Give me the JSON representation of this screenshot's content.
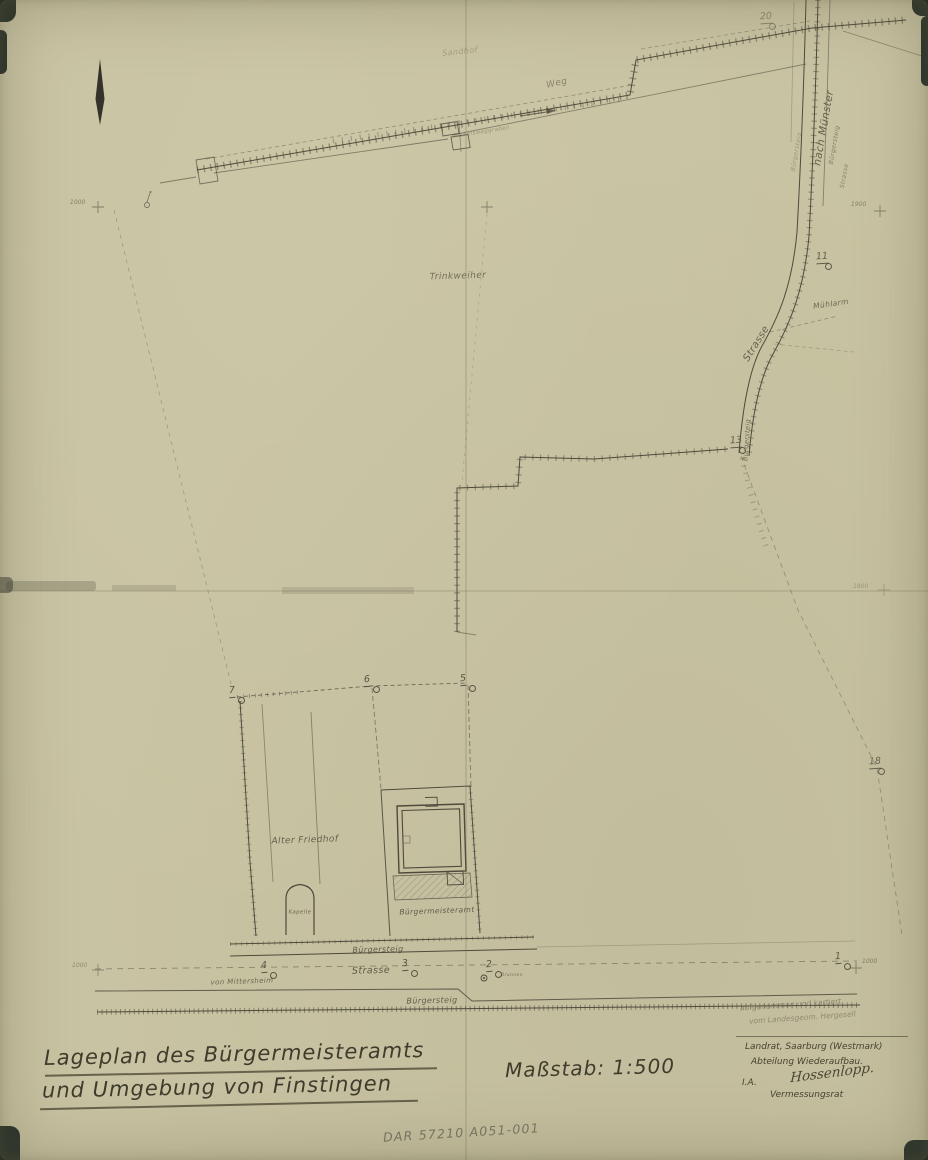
{
  "colors": {
    "paper": "#c8c3a2",
    "ink": "#4e4a3c",
    "faint_ink": "#80785f",
    "pencil": "#6d6959",
    "backdrop": "#28332c"
  },
  "annotations": {
    "title_line1": "Lageplan des Bürgermeisteramts",
    "title_line2": "und Umgebung von Finstingen",
    "scale": "Maßstab: 1:500",
    "credit_line1": "aufgenommen und kartiert",
    "credit_line2": "vom Landesgeom. Hergesell",
    "office_line1": "Landrat, Saarburg (Westmark)",
    "office_line2": "Abteilung Wiederaufbau.",
    "office_ia": "I.A.",
    "office_signature": "Hossenlopp.",
    "office_role": "Vermessungsrat",
    "archive_ref": "DAR 57210 A051-001"
  },
  "map": {
    "labels": [
      {
        "id": "sandhof",
        "text": "Sandhof",
        "x": 460,
        "y": 52,
        "rot": -6,
        "size": 8,
        "op": 0.32
      },
      {
        "id": "weg",
        "text": "Weg",
        "x": 557,
        "y": 84,
        "rot": -12,
        "size": 9,
        "op": 0.55
      },
      {
        "id": "weggraben",
        "text": "Rickelsweggraben",
        "x": 482,
        "y": 133,
        "rot": -9,
        "size": 5.5,
        "op": 0.42
      },
      {
        "id": "trinkweiher",
        "text": "Trinkweiher",
        "x": 458,
        "y": 277,
        "rot": -2,
        "size": 9,
        "op": 0.75
      },
      {
        "id": "nach-muenster",
        "text": "nach Münster",
        "x": 824,
        "y": 128,
        "rot": -80,
        "size": 10.5,
        "op": 0.85
      },
      {
        "id": "buergersteig-muenster",
        "text": "Bürgersteig",
        "x": 835,
        "y": 145,
        "rot": -80,
        "size": 6,
        "op": 0.6
      },
      {
        "id": "strasse-muenster",
        "text": "Strasse",
        "x": 845,
        "y": 176,
        "rot": -80,
        "size": 6,
        "op": 0.55
      },
      {
        "id": "buergersteig-saar",
        "text": "Bürgersteig",
        "x": 797,
        "y": 152,
        "rot": -80,
        "size": 6,
        "op": 0.38
      },
      {
        "id": "muehlarm",
        "text": "Mühlarm",
        "x": 831,
        "y": 304,
        "rot": -8,
        "size": 7.5,
        "op": 0.8
      },
      {
        "id": "strasse-diagonal",
        "text": "Strasse",
        "x": 757,
        "y": 344,
        "rot": -58,
        "size": 10,
        "op": 0.85
      },
      {
        "id": "buergersteig-kurve",
        "text": "Bürgersteig",
        "x": 747,
        "y": 440,
        "rot": -86,
        "size": 6.5,
        "op": 0.75
      },
      {
        "id": "alter-friedhof",
        "text": "Alter Friedhof",
        "x": 305,
        "y": 841,
        "rot": -2,
        "size": 9,
        "op": 0.85
      },
      {
        "id": "kapelle",
        "text": "Kapelle",
        "x": 300,
        "y": 913,
        "rot": 0,
        "size": 5.5,
        "op": 0.8
      },
      {
        "id": "buergermeisteramt",
        "text": "Bürgermeisteramt",
        "x": 437,
        "y": 911,
        "rot": -2,
        "size": 7.5,
        "op": 0.9
      },
      {
        "id": "buergersteig-oben",
        "text": "Bürgersteig",
        "x": 378,
        "y": 950,
        "rot": -1.5,
        "size": 8,
        "op": 0.9
      },
      {
        "id": "strasse-unten",
        "text": "Strasse",
        "x": 371,
        "y": 971,
        "rot": -1.5,
        "size": 9.5,
        "op": 0.9
      },
      {
        "id": "von-mittersheim",
        "text": "von Mittersheim",
        "x": 242,
        "y": 982,
        "rot": -2,
        "size": 7,
        "op": 0.8
      },
      {
        "id": "brunnen",
        "text": "Brunnen",
        "x": 512,
        "y": 976,
        "rot": 0,
        "size": 4.5,
        "op": 0.7
      },
      {
        "id": "buergersteig-unten",
        "text": "Bürgersteig",
        "x": 432,
        "y": 1001,
        "rot": -1.5,
        "size": 8,
        "op": 0.9
      }
    ],
    "survey_points": [
      {
        "n": "20",
        "x": 760,
        "y": 12,
        "op": 0.5
      },
      {
        "n": "11",
        "x": 816,
        "y": 252,
        "op": 0.85
      },
      {
        "n": "13",
        "x": 730,
        "y": 436,
        "op": 0.85
      },
      {
        "n": "18",
        "x": 869,
        "y": 757,
        "op": 0.8
      },
      {
        "n": "7",
        "x": 229,
        "y": 686,
        "op": 0.9
      },
      {
        "n": "6",
        "x": 364,
        "y": 675,
        "op": 0.9
      },
      {
        "n": "5",
        "x": 460,
        "y": 674,
        "op": 0.9
      },
      {
        "n": "4",
        "x": 261,
        "y": 961,
        "op": 0.9
      },
      {
        "n": "3",
        "x": 402,
        "y": 959,
        "op": 0.9
      },
      {
        "n": "2",
        "x": 486,
        "y": 960,
        "op": 0.9
      },
      {
        "n": "1",
        "x": 835,
        "y": 952,
        "op": 0.9
      }
    ],
    "grid_marks": [
      {
        "text": "1000",
        "x": 70,
        "y": 200,
        "size": 6,
        "op": 0.6
      },
      {
        "text": "1900",
        "x": 851,
        "y": 202,
        "size": 6,
        "op": 0.55
      },
      {
        "text": "1800",
        "x": 853,
        "y": 584,
        "size": 6,
        "op": 0.35
      },
      {
        "text": "1000",
        "x": 72,
        "y": 963,
        "size": 6,
        "op": 0.5
      },
      {
        "text": "1000",
        "x": 862,
        "y": 959,
        "size": 6,
        "op": 0.6
      }
    ]
  }
}
